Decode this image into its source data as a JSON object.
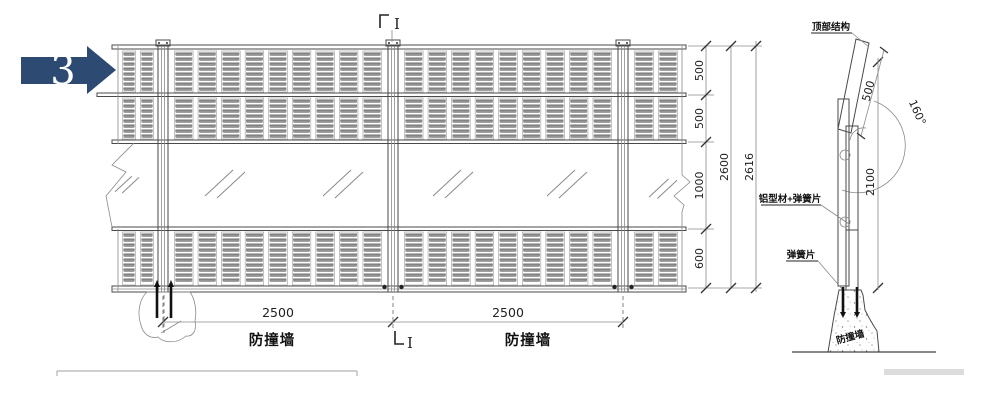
{
  "annotation": {
    "step_number": "3"
  },
  "colors": {
    "arrow_fill": "#2c4a72",
    "ink": "#4a4a4a",
    "louver_gray": "#949494"
  },
  "elevation": {
    "section_cut": {
      "top_label": "I",
      "bottom_label": "I"
    },
    "bottom_dimensions": {
      "spans": [
        "2500",
        "2500"
      ],
      "wall_labels": [
        "防撞墙",
        "防撞墙"
      ]
    },
    "height_dimensions": {
      "segments": [
        "500",
        "500",
        "1000",
        "600"
      ],
      "subtotal": "2600",
      "total": "2616"
    }
  },
  "section_view": {
    "labels": {
      "top_structure": "顶部结构",
      "aluminum_profile": "铝型材+弹簧片",
      "spring_plate": "弹簧片",
      "crash_wall": "防撞墙"
    },
    "dimensions": {
      "panel_length": "500",
      "angle": "160°",
      "post_height": "2100"
    }
  }
}
